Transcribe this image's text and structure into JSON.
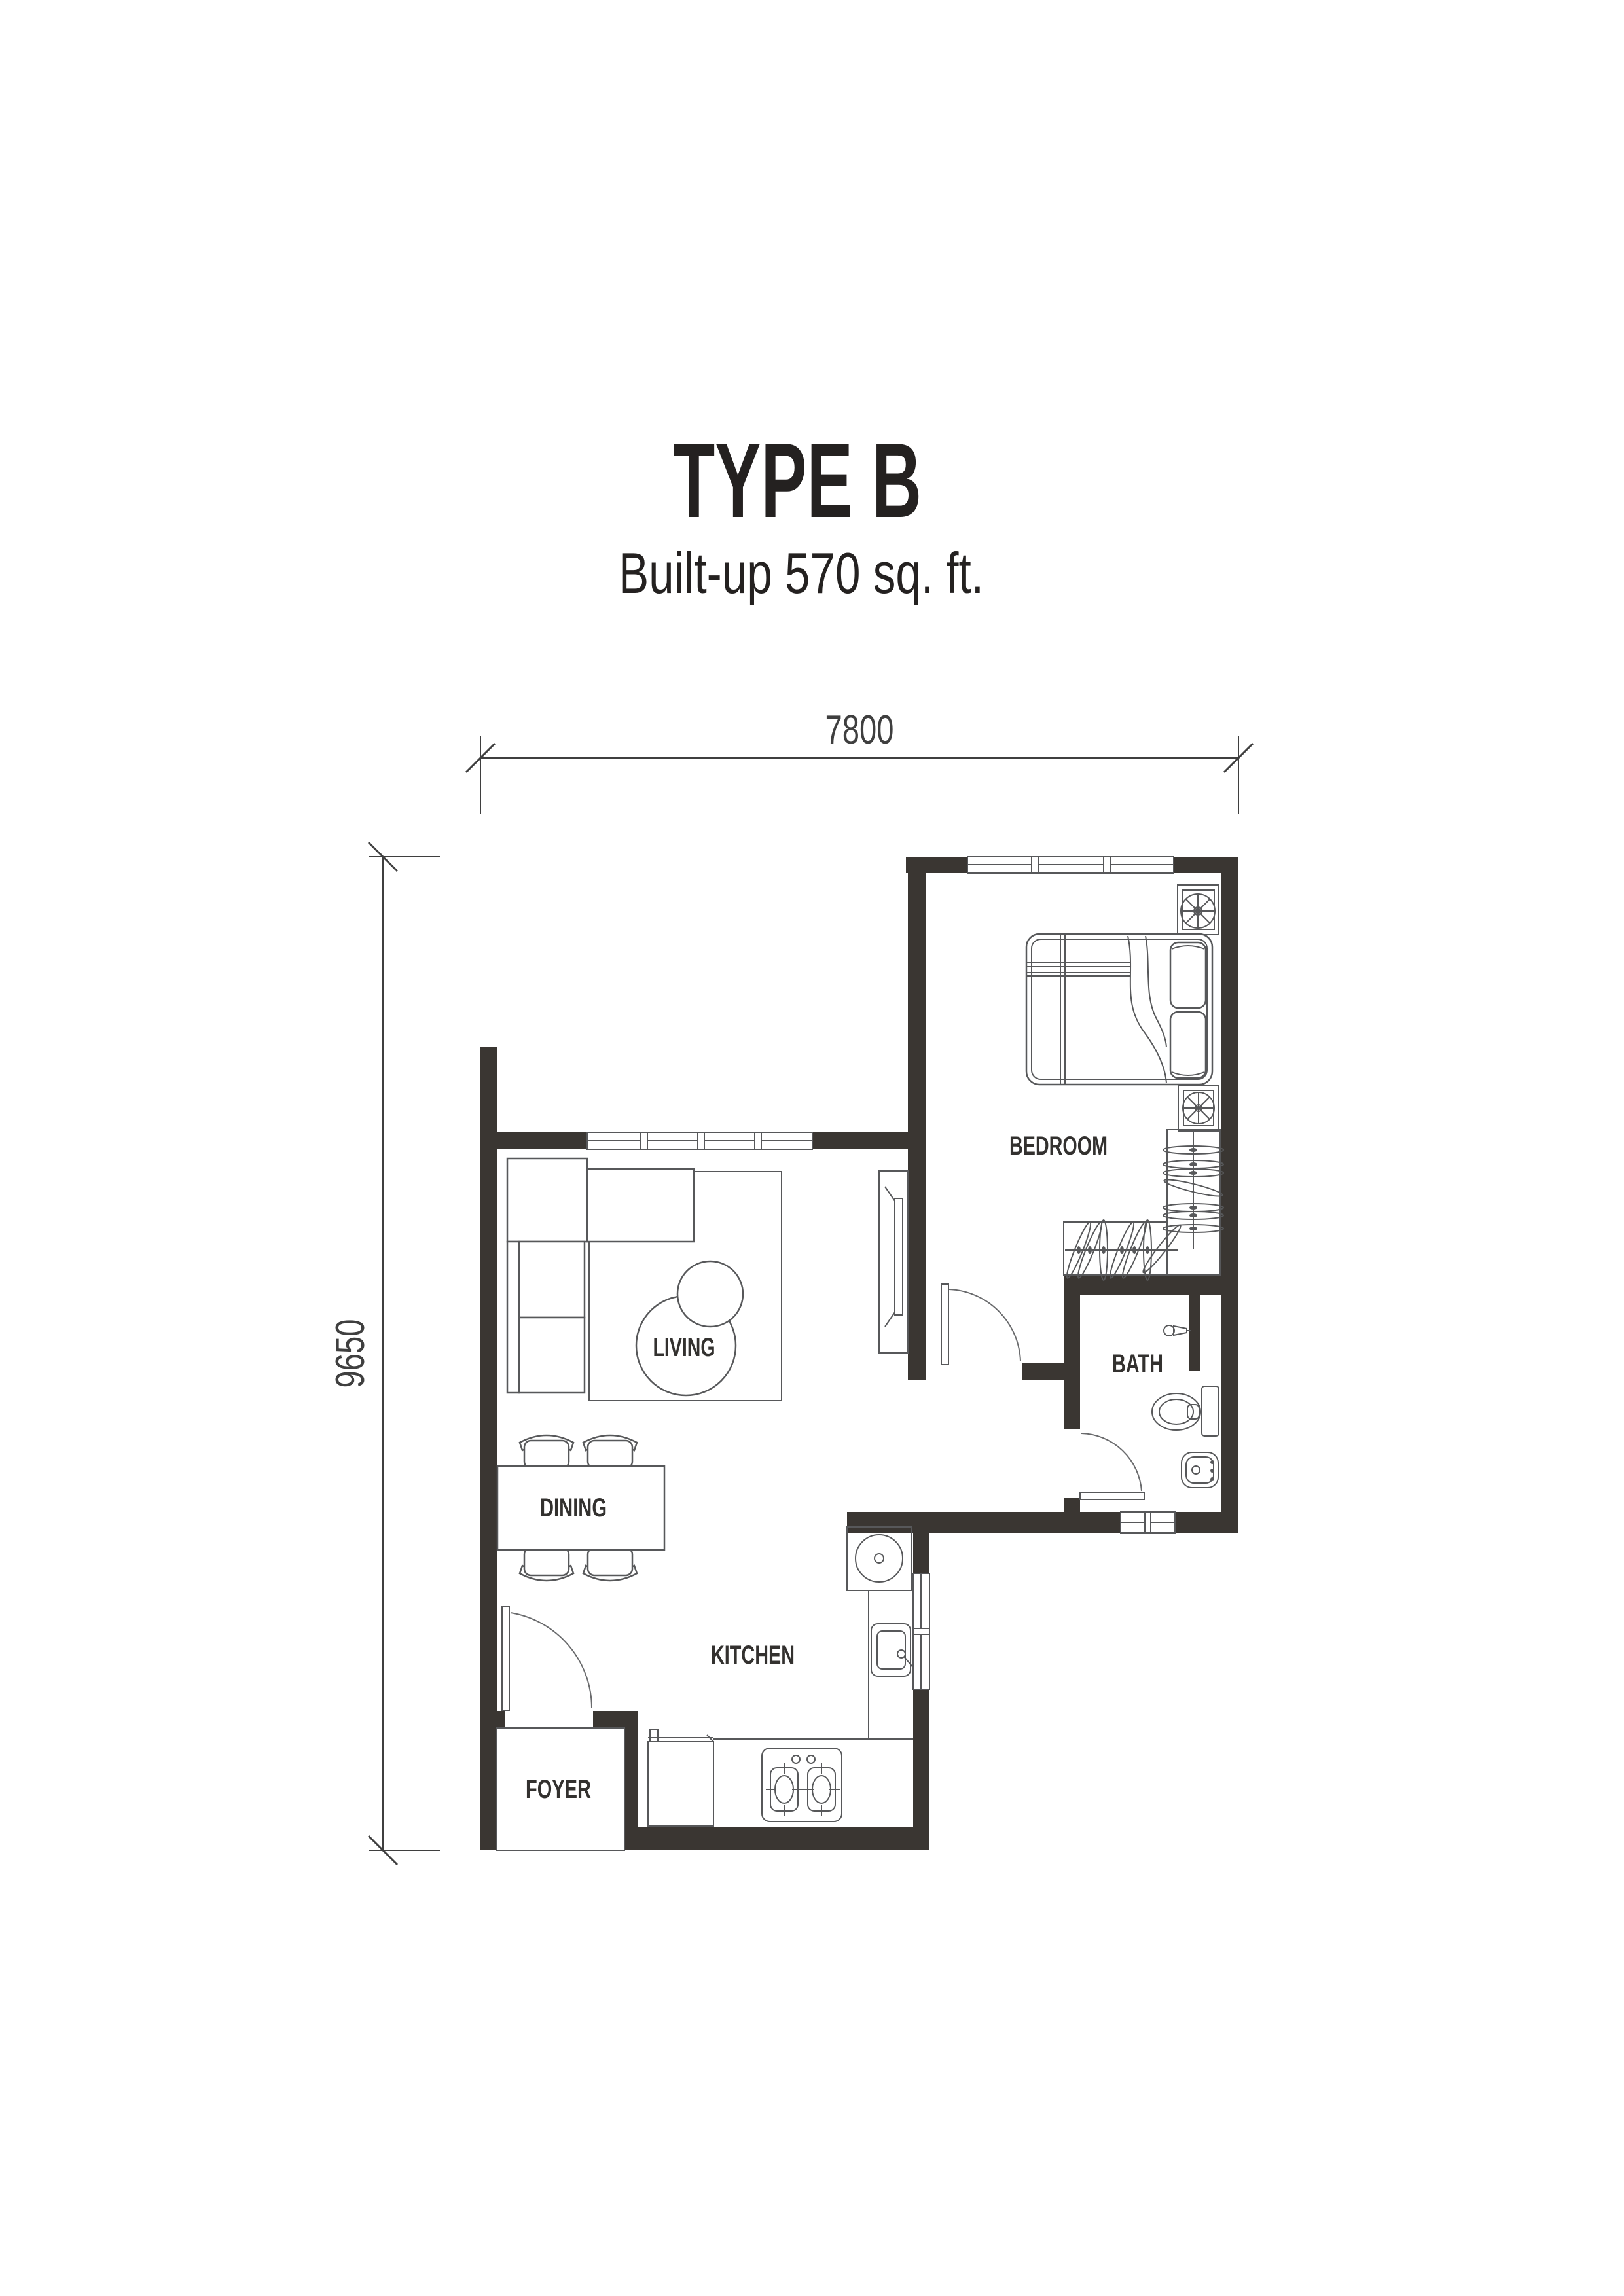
{
  "header": {
    "title": "TYPE B",
    "subtitle": "Built-up 570 sq. ft."
  },
  "dimensions": {
    "top_width": "7800",
    "left_height": "9650",
    "unit": "mm"
  },
  "rooms": {
    "bedroom": {
      "label": "BEDROOM",
      "furniture": [
        "double-bed",
        "pillows",
        "blanket",
        "wardrobe-with-hangers",
        "ac-ledge-fan-top",
        "ac-ledge-fan-bottom",
        "window"
      ]
    },
    "living": {
      "label": "LIVING",
      "furniture": [
        "l-shaped-sofa",
        "rug",
        "round-coffee-tables",
        "tv-console",
        "window"
      ]
    },
    "dining": {
      "label": "DINING",
      "furniture": [
        "dining-table",
        "chairs-4"
      ]
    },
    "kitchen": {
      "label": "KITCHEN",
      "furniture": [
        "washing-machine",
        "kitchen-sink",
        "l-counter",
        "gas-stove-2-burner",
        "fridge-cabinet",
        "window"
      ]
    },
    "bath": {
      "label": "BATH",
      "furniture": [
        "toilet",
        "wash-basin",
        "shower-head",
        "duct-niche",
        "window"
      ]
    },
    "foyer": {
      "label": "FOYER",
      "furniture": [
        "entry-door"
      ]
    }
  },
  "doors": [
    "entry-door-swing",
    "bedroom-door-swing",
    "bath-door-swing"
  ],
  "colors": {
    "background": "#ffffff",
    "wall": "#3a3632",
    "furniture_line": "#57585a",
    "label_text": "#33312f",
    "title_text": "#242120",
    "dimension_line": "#3f3f3f"
  }
}
